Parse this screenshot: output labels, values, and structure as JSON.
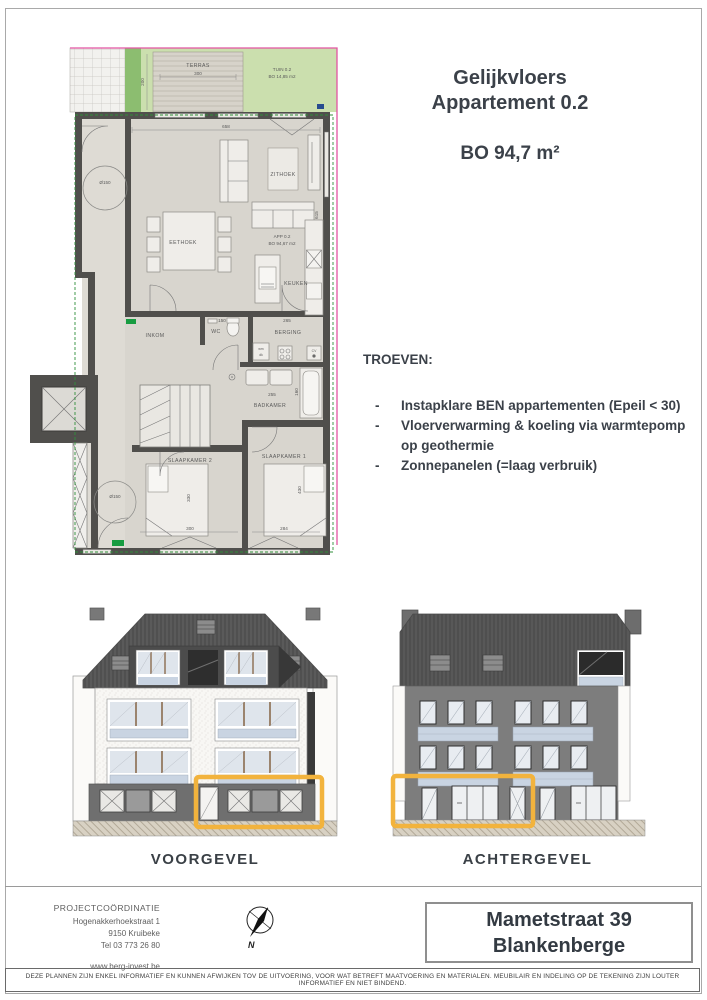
{
  "title": {
    "line1": "Gelijkvloers",
    "line2": "Appartement 0.2",
    "area": "BO 94,7 m²"
  },
  "troeven": {
    "heading": "TROEVEN:",
    "bullet": "-",
    "items": [
      "Instapklare BEN appartementen (Epeil < 30)",
      "Vloerverwarming & koeling via warmtepomp op geothermie",
      "Zonnepanelen (=laag verbruik)"
    ]
  },
  "plan": {
    "terras": "TERRAS",
    "tuin_line1": "TUIN  0.2",
    "tuin_line2": "BO 14,85  m2",
    "zithoek": "ZITHOEK",
    "eethoek": "EETHOEK",
    "app_line1": "APP  0.2",
    "app_line2": "BO  94,67  m2",
    "keuken": "KEUKEN",
    "inkom": "INKOM",
    "wc": "WC",
    "berging": "BERGING",
    "badkamer": "BADKAMER",
    "slaapkamer2": "SLAAPKAMER  2",
    "slaapkamer1": "SLAAPKAMER  1",
    "wm": "wm",
    "dk": "dk",
    "cv": "CV",
    "dims": {
      "d658": "658",
      "d615": "615",
      "d300t": "300",
      "d200": "200",
      "d150": "150",
      "d265": "265",
      "d255": "255",
      "d160": "160",
      "d300s": "300",
      "d284": "284",
      "d330": "330",
      "d430": "430",
      "dia150": "Ø150"
    }
  },
  "elevations": {
    "front": "VOORGEVEL",
    "rear": "ACHTERGEVEL",
    "highlight_color": "#F2B33D"
  },
  "footer": {
    "coord_title": "PROJECTCOÖRDINATIE",
    "address1": "Hogenakkerhoekstraat 1",
    "address2": "9150 Kruibeke",
    "phone": "Tel 03 773 26 80",
    "website": "www.berg-invest.be",
    "north": "N",
    "project_line1": "Mametstraat 39",
    "project_line2": "Blankenberge"
  },
  "disclaimer": "DEZE PLANNEN ZIJN ENKEL INFORMATIEF EN KUNNEN AFWIJKEN TOV DE UITVOERING, VOOR WAT BETREFT MAATVOERING EN MATERIALEN. MEUBILAIR EN INDELING OP DE TEKENING ZIJN LOUTER INFORMATIEF EN NIET BINDEND."
}
